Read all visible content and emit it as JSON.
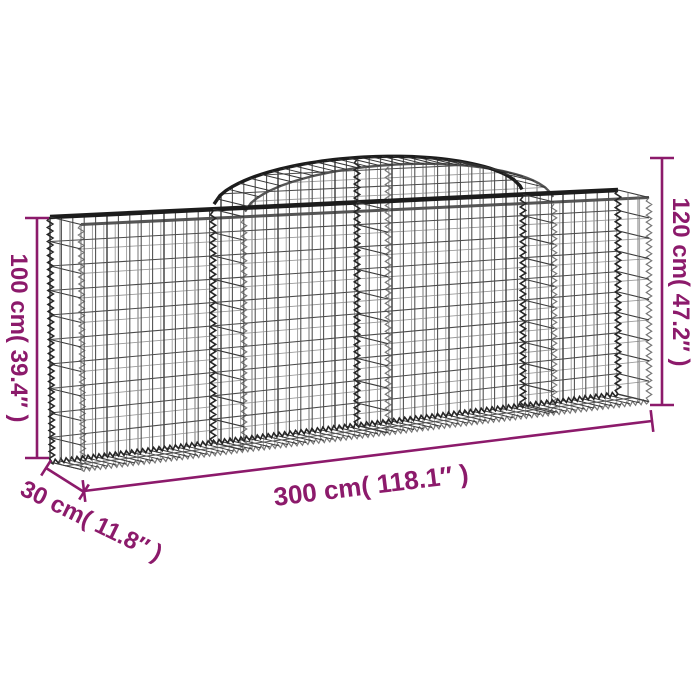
{
  "page": {
    "background": "#ffffff"
  },
  "colors": {
    "dimension_accent": "#8c1a6b",
    "wire_dark": "#1f1f1f",
    "wire_mid": "#4c4c4c",
    "wire_light": "#9a9a9a"
  },
  "diagram": {
    "product": "arched gabion wire mesh basket",
    "height_left_label": "100 cm( 39.4″ )",
    "height_right_label": "120 cm( 47.2″ )",
    "width_label": "300 cm( 118.1″ )",
    "depth_label": "30 cm( 11.8″ )"
  }
}
